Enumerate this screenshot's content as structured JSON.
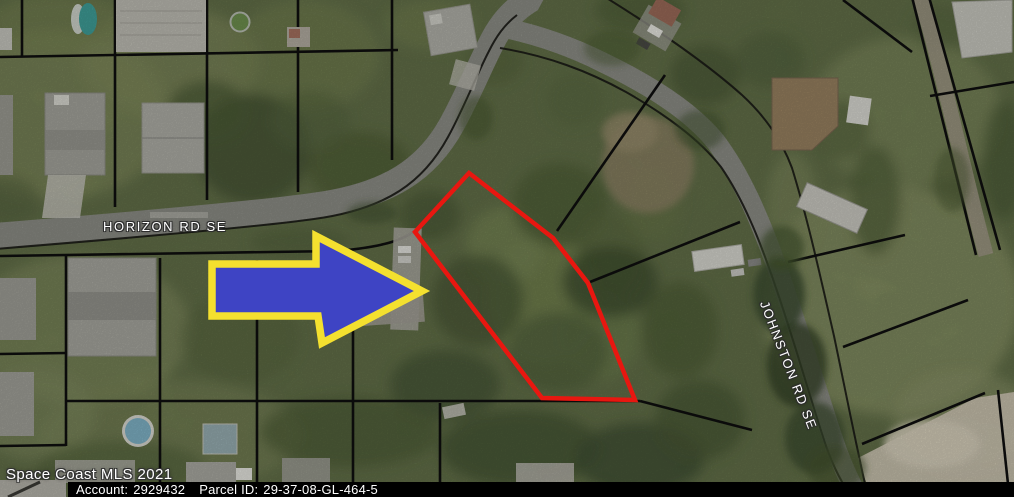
{
  "map": {
    "streets": {
      "horizon": "HORIZON RD SE",
      "johnston": "JOHNSTON RD SE"
    },
    "watermark": "Space Coast MLS 2021",
    "parcel": {
      "outline_color": "#e81710"
    },
    "arrow": {
      "fill_color": "#3e44c4",
      "border_color": "#f4e02f"
    },
    "colors": {
      "road": "#8b8c85",
      "boundary_line": "#0e0e0e",
      "footer_bar": "#000000",
      "footer_text": "#ffffff"
    }
  },
  "footer": {
    "account_label": "Account:",
    "account_value": "2929432",
    "parcel_label": "Parcel ID:",
    "parcel_value": "29-37-08-GL-464-5"
  }
}
